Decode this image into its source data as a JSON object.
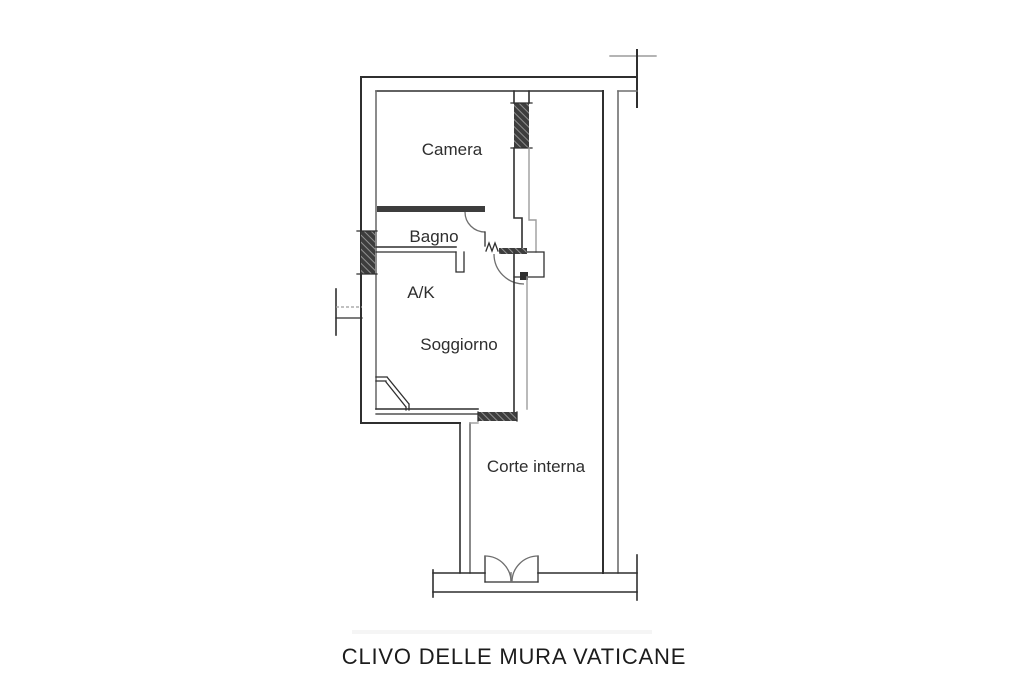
{
  "floor_plan": {
    "rooms": {
      "camera": {
        "label": "Camera"
      },
      "bagno": {
        "label": "Bagno"
      },
      "ak": {
        "label": "A/K"
      },
      "soggiorno": {
        "label": "Soggiorno"
      },
      "corte_interna": {
        "label": "Corte interna"
      }
    },
    "caption": "CLIVO DELLE MURA VATICANE",
    "colors": {
      "background": "#ffffff",
      "wall_dark": "#2f2f2f",
      "wall_mid": "#6e6e6e",
      "wall_light": "#9c9c9c",
      "window_fill": "#3d3d3d",
      "label_text": "#2e2e2e",
      "caption_text": "#1c1c1c"
    }
  }
}
